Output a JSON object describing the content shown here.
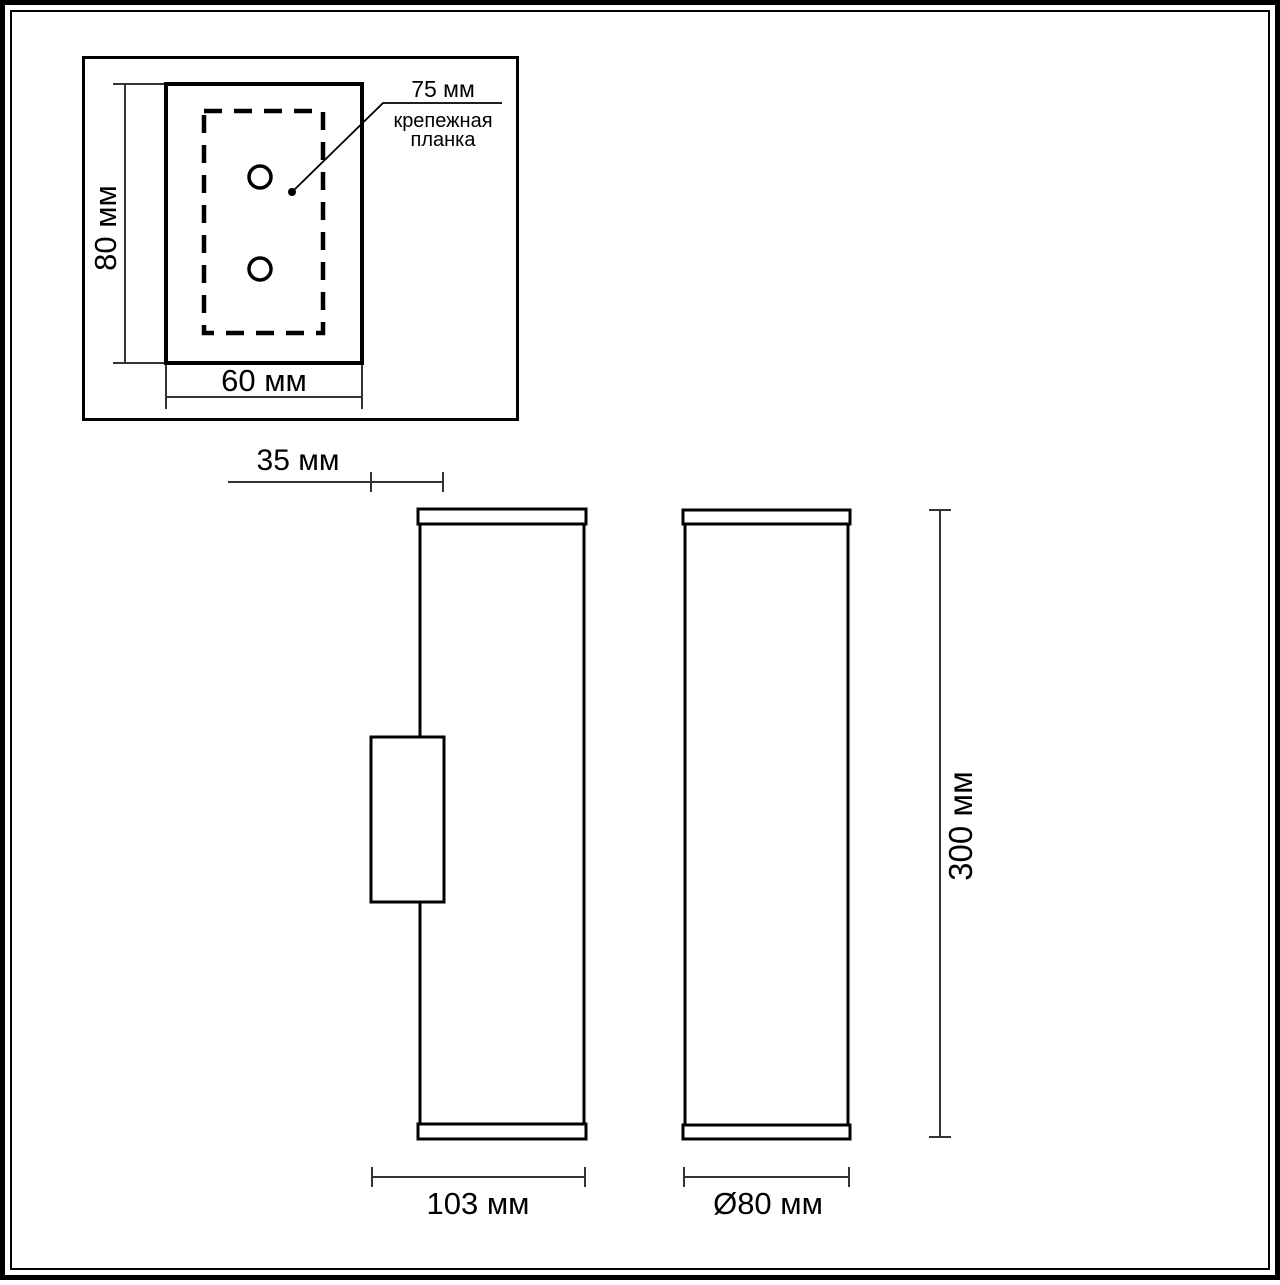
{
  "colors": {
    "outline": "#000000",
    "dimension_line": "#333333",
    "background": "#ffffff"
  },
  "inset": {
    "height_label": "80 мм",
    "width_label": "60 мм",
    "holes_label": "75 мм",
    "callout": {
      "line1": "крепежная",
      "line2": "планка"
    }
  },
  "side_view": {
    "bracket_offset_label": "35 мм",
    "depth_label": "103 мм"
  },
  "front_view": {
    "diameter_label": "Ø80 мм",
    "height_label": "300 мм"
  }
}
